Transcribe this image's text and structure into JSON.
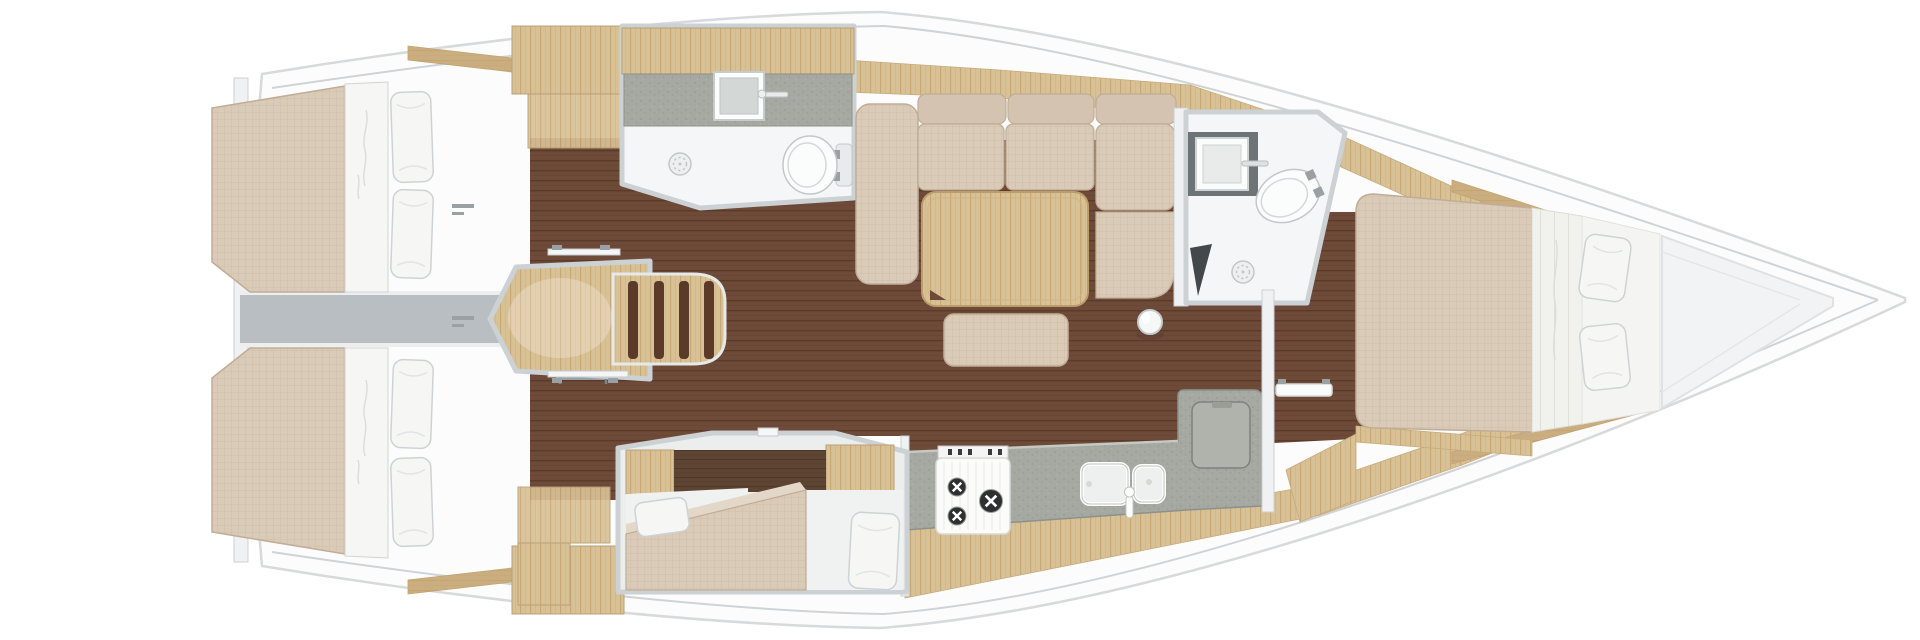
{
  "app": {
    "type": "yacht-interior-floor-plan",
    "view": "top-down",
    "orientation": "bow-right"
  },
  "palette": {
    "hull_fill": "#fcfcfc",
    "hull_stroke": "#d7d9da",
    "deck_line": "#cfd3d5",
    "floor_base": "#6e4a38",
    "floor_line": "#5b3a2a",
    "wood_base": "#d9c196",
    "wood_grain": "#c3a370",
    "wood_mid": "#cbae80",
    "fabric_base": "#dacbb8",
    "fabric_line": "#cdbba6",
    "fabric_edge": "#c0ad97",
    "bedding": "#f6f6f5",
    "bedding_stroke": "#d2d4d4",
    "wall_fill": "#eff1f2",
    "wall_stroke": "#ccd1d4",
    "counter_base": "#a6a8a2",
    "counter_dot": "#8f9189",
    "gray_bar": "#b9bec2",
    "fixture": "#fbfcfc",
    "fixture_stroke": "#c6cbcd",
    "dark_counter": "#6d7477",
    "metal": "#9aa1a5",
    "darkwood_base": "#5e4433",
    "darkwood_line": "#4f3728",
    "boards_base": "#f1f1ee",
    "boards_line": "#e0dfd8",
    "burner": "#2d2f31",
    "table_fill": "#ddc89d",
    "table_edge": "#bb9c6a"
  },
  "rooms": {
    "hull": {
      "label": "sailing yacht hull, bow pointing right"
    },
    "aft_cabin_port": {
      "label": "aft cabin port side with double berth, two pillows and wardrobe"
    },
    "aft_cabin_starboard": {
      "label": "aft cabin starboard side with double berth, two pillows and wardrobe"
    },
    "transom_passage": {
      "label": "engine compartment passage between aft cabins"
    },
    "companionway": {
      "label": "companionway entry steps with wooden treads"
    },
    "head_port": {
      "label": "port head with sink, shower drain and toilet"
    },
    "salon": {
      "label": "salon with L-shaped settee, folding table, ottoman and mast post"
    },
    "galley": {
      "label": "galley with three-burner stove, double sink and top-loading fridge"
    },
    "cabin_mid": {
      "label": "mid cabin with angled berth and pillows"
    },
    "head_forward": {
      "label": "forward head with vanity sink, toilet and shower drain"
    },
    "cabin_forward": {
      "label": "forward cabin island berth with two pillows"
    },
    "bow": {
      "label": "bow storage lockers"
    }
  },
  "furniture": {
    "berth_count": 4,
    "pillow_count": 8,
    "head_count": 2,
    "stove_burners": 3,
    "sink_basins_galley": 2,
    "stair_treads": 4
  }
}
